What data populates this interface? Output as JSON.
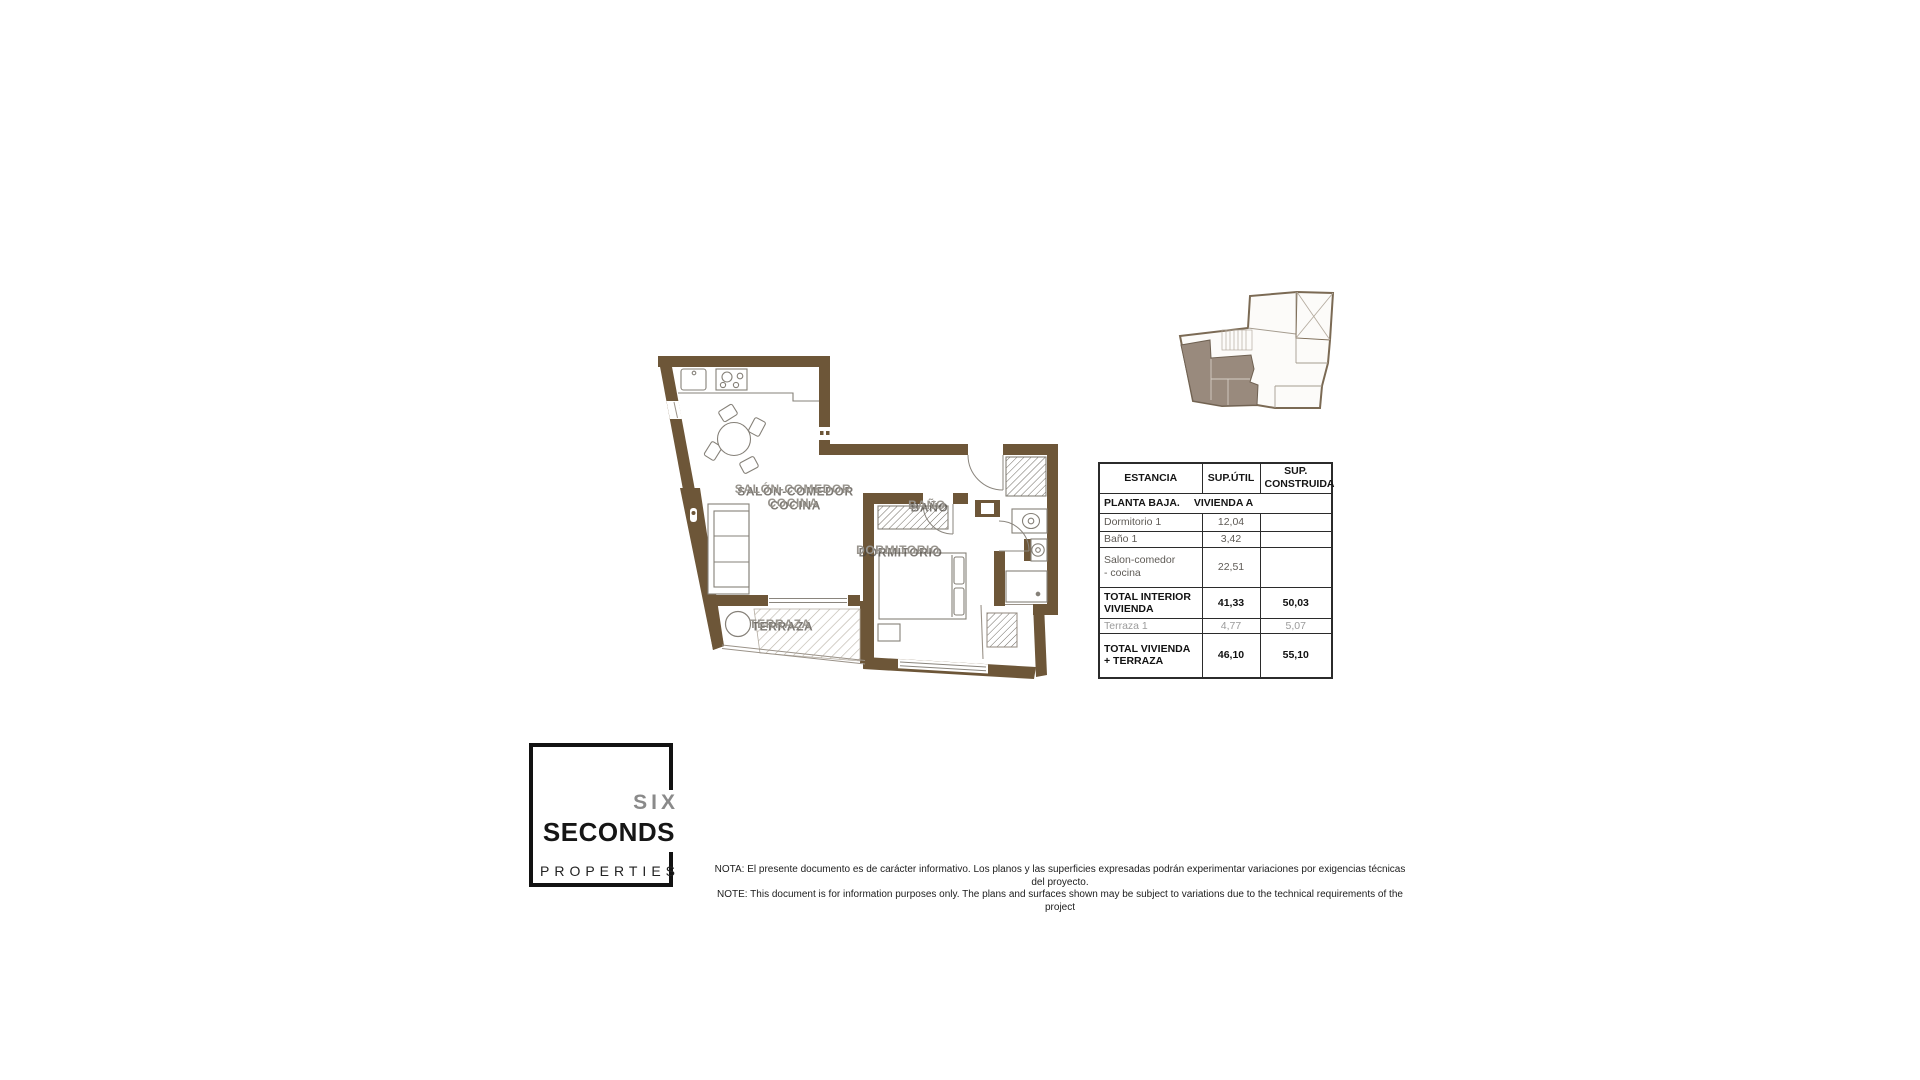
{
  "plan": {
    "labels": {
      "salon_line1": "SALÓN-COMEDOR",
      "salon_line2": "COCINA",
      "dormitorio": "DORMITORIO",
      "bano": "BAÑO",
      "terraza": "TERRAZA"
    },
    "wall_color": "#6d5638"
  },
  "key_plan": {
    "wall_color": "#7b6a54",
    "highlight_color": "#998a7d"
  },
  "table": {
    "headers": {
      "col1": "ESTANCIA",
      "col2": "SUP.ÚTIL",
      "col3": "SUP. CONSTRUIDA"
    },
    "section": {
      "floor": "PLANTA BAJA.",
      "unit": "VIVIENDA A"
    },
    "rows": [
      {
        "name": "Dormitorio 1",
        "util": "12,04",
        "construida": ""
      },
      {
        "name": "Baño 1",
        "util": "3,42",
        "construida": ""
      },
      {
        "name": "Salon-comedor - cocina",
        "util": "22,51",
        "construida": ""
      },
      {
        "name": "TOTAL INTERIOR VIVIENDA",
        "util": "41,33",
        "construida": "50,03"
      },
      {
        "name": "Terraza 1",
        "util": "4,77",
        "construida": "5,07"
      },
      {
        "name": "TOTAL VIVIENDA + TERRAZA",
        "util": "46,10",
        "construida": "55,10"
      }
    ]
  },
  "logo": {
    "six": "SIX",
    "seconds": "SECONDS",
    "properties": "PROPERTIES"
  },
  "disclaimer": {
    "line1": "NOTA: El presente documento es de carácter informativo. Los planos y las superficies expresadas podrán experimentar variaciones por exigencias técnicas del proyecto.",
    "line2": "NOTE: This document is for information purposes only. The plans and surfaces shown may be subject to variations due to the technical requirements of the project"
  }
}
